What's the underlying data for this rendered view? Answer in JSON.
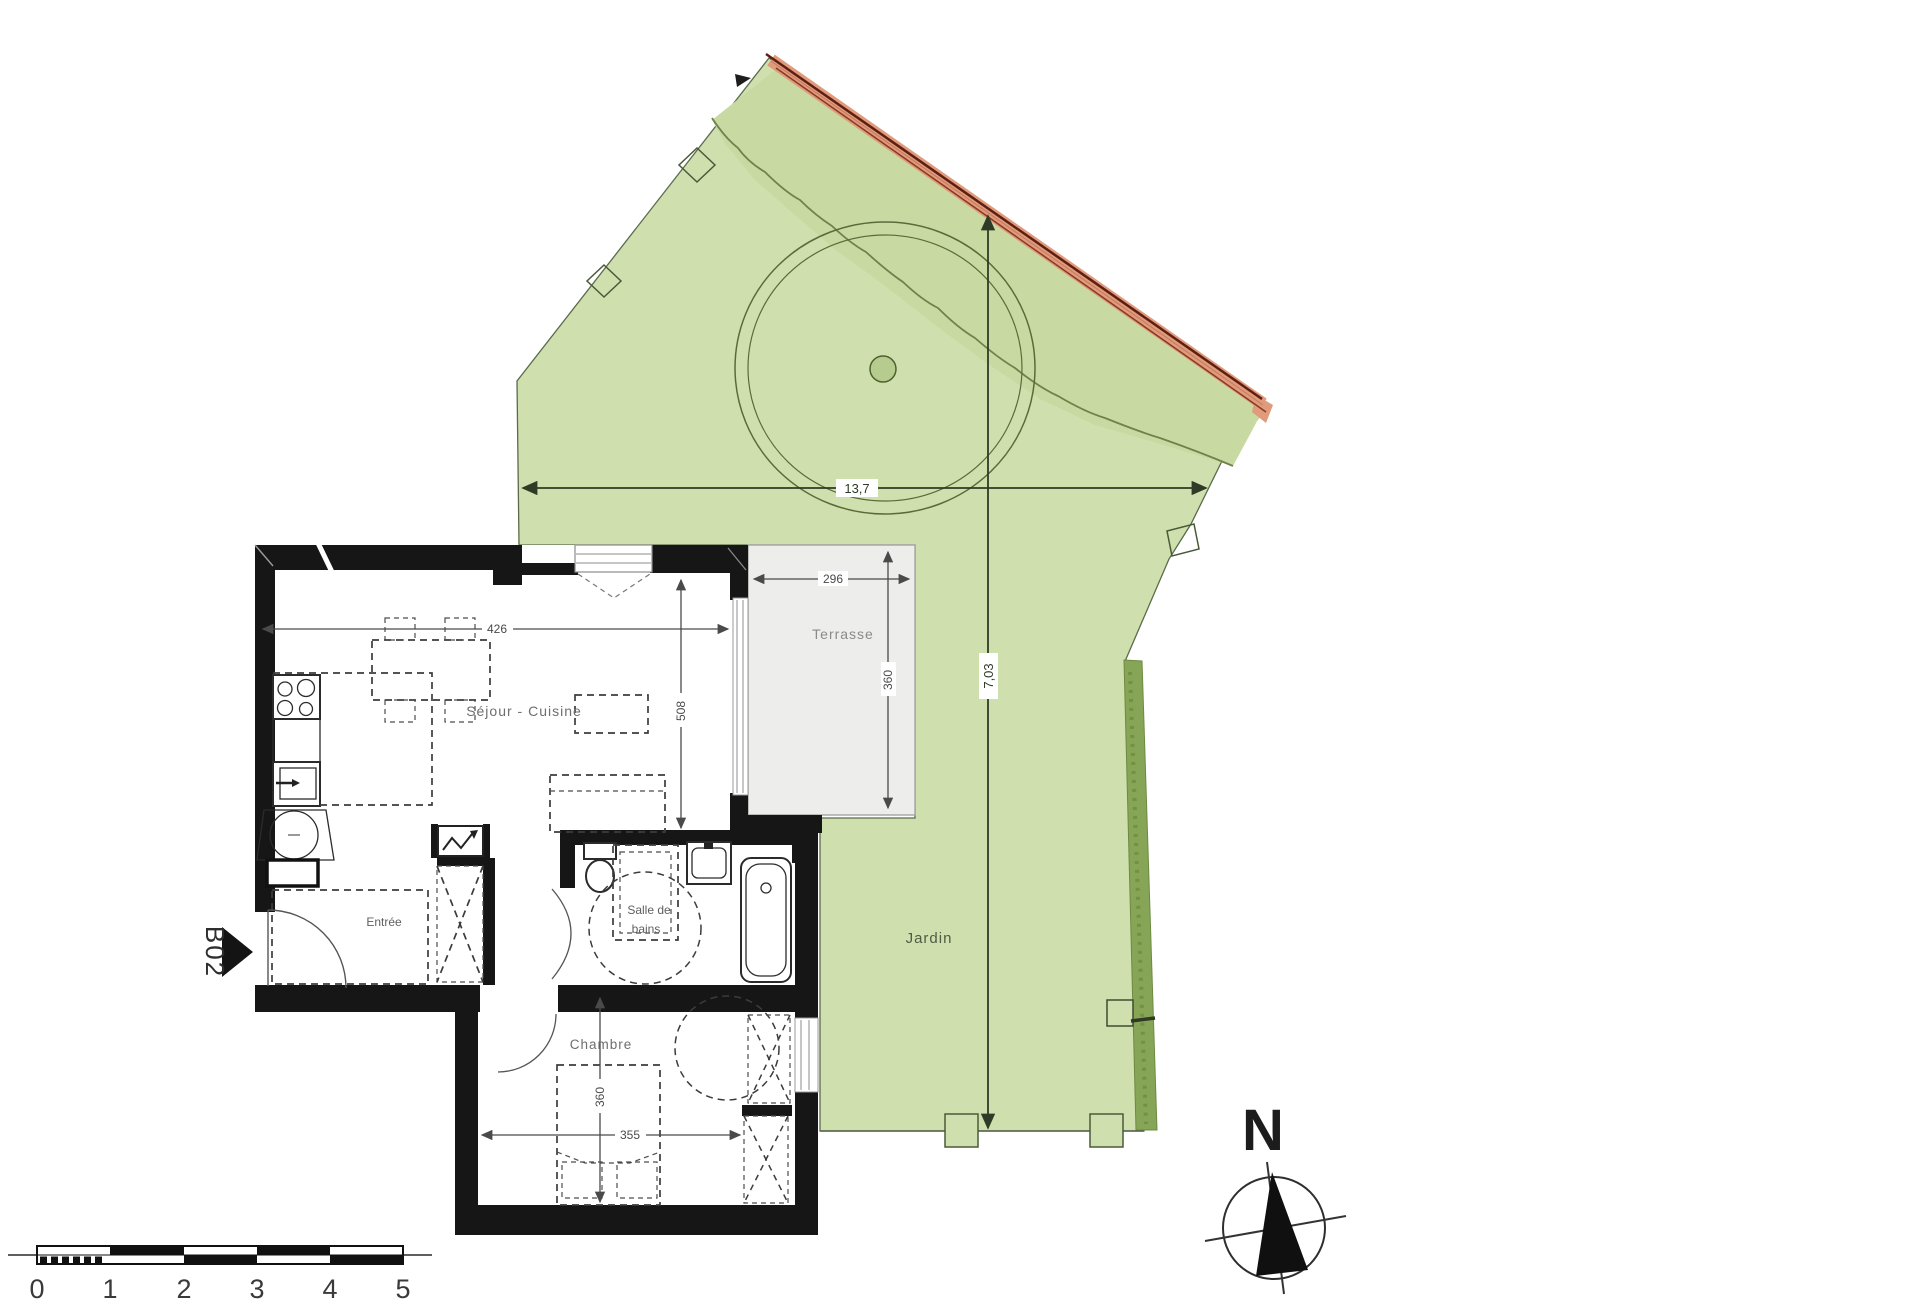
{
  "plan": {
    "unit_label": "B02",
    "rooms": {
      "living": "Séjour - Cuisine",
      "terrace": "Terrasse",
      "garden": "Jardin",
      "entry": "Entrée",
      "bath_line1": "Salle de",
      "bath_line2": "bains",
      "bedroom": "Chambre"
    },
    "dimensions": {
      "living_width": "426",
      "living_height": "508",
      "terrace_width": "296",
      "terrace_height": "360",
      "bedroom_width": "355",
      "bedroom_height": "360",
      "garden_width": "13,7",
      "garden_height": "7,03"
    },
    "compass": {
      "north_label": "N"
    },
    "scalebar": {
      "ticks": [
        "0",
        "1",
        "2",
        "3",
        "4",
        "5"
      ]
    },
    "colors": {
      "garden_green": "#cfe0ae",
      "garden_dark_green": "#c8daa2",
      "hedge_green": "#87a557",
      "roof_band": "#e09a7c",
      "terrace_gray": "#ededeb",
      "wall_black": "#161616"
    }
  }
}
